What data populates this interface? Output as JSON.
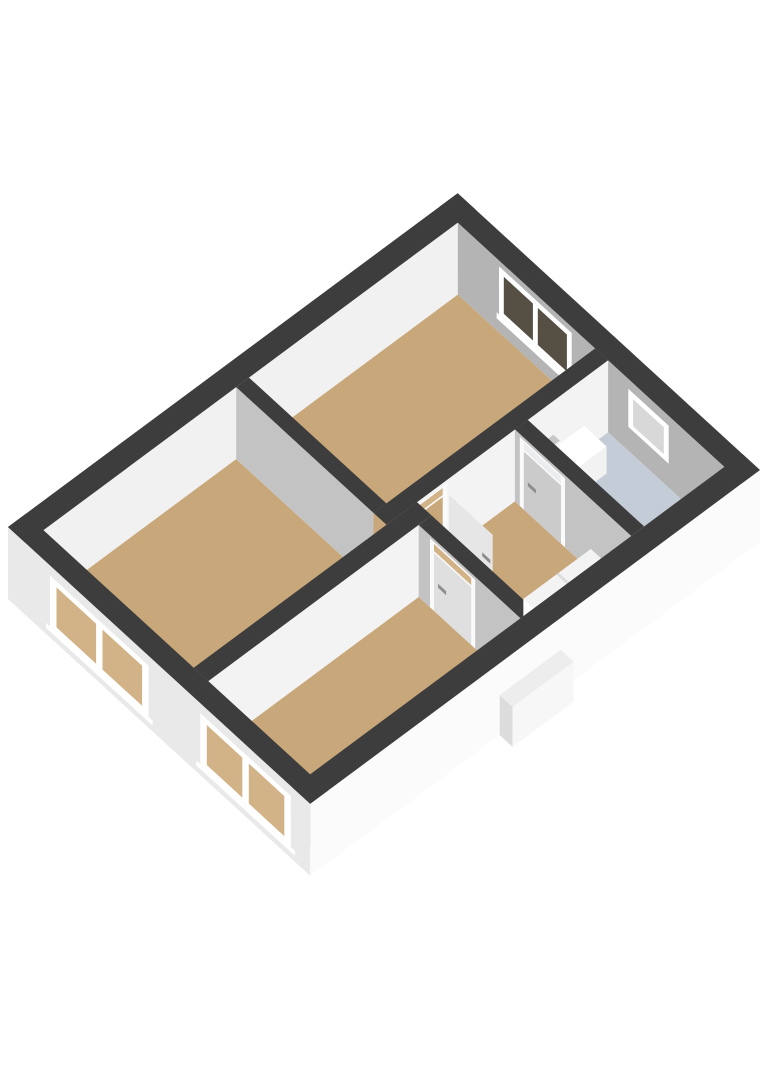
{
  "scene": {
    "width": 768,
    "height": 1086,
    "background": "#ffffff",
    "description-name": "floorplan-3d-view"
  },
  "projection": {
    "origin": [
      8,
      527
    ],
    "u": [
      0.803,
      -0.596
    ],
    "v": [
      0.808,
      0.74
    ],
    "wall_height": 72
  },
  "colors": {
    "cap": "#3d3d3d",
    "floorWood": "#c8a77b",
    "floorBath": "#c3ccd7",
    "innerNW": "#f1f1f1",
    "innerNE": "#b4b4b4",
    "faceBright": "#f3f3f3",
    "facePart": "#c3c3c3",
    "outerSW": "#e9e9e9",
    "outerSE": "#fbfbfb",
    "white": "#ffffff",
    "frame": "#fafafa",
    "glassDark": "#565044",
    "glassLight": "#d8d8d8",
    "glassWood": "#d2b287",
    "doorOpen": "#e6e6e6",
    "doorB": "#cbcbcb",
    "doorC": "#dfdfdf",
    "transomLight": "#e9edf0",
    "handle": "#8d8d8d",
    "stairTop": "#f3f3f3",
    "stairFront": "#fcfcfc",
    "stairSide": "#e8e8e8",
    "stepLine": "#dddddd",
    "sinkFront": "#f2f2f2",
    "sinkSide": "#dadada",
    "faucet": "#9f9f9f",
    "faucetTop": "#c7c7c7",
    "bumpSide": "#dcdcdc",
    "bumpFront": "#f7f7f7",
    "bumpTop": "#ededed"
  },
  "shapes": [
    {
      "name": "nw-wall-inner-face",
      "kind": "wally",
      "at": 22,
      "rect": [
        22,
        0,
        538,
        72
      ],
      "color": "innerNW"
    },
    {
      "name": "ne-wall-inner-face",
      "kind": "wallx",
      "at": 538,
      "rect": [
        22,
        0,
        352,
        72
      ],
      "color": "innerNE"
    },
    {
      "name": "bedroom2-window-sill",
      "kind": "wallx",
      "at": 538,
      "rect": [
        70,
        12,
        166,
        18
      ],
      "color": "white"
    },
    {
      "name": "bedroom2-window-frame",
      "kind": "wallx",
      "at": 538,
      "rect": [
        73,
        18,
        163,
        66
      ],
      "color": "white"
    },
    {
      "name": "bedroom2-window-glass-left",
      "kind": "wallx",
      "at": 538,
      "rect": [
        79,
        23,
        115,
        60
      ],
      "color": "glassDark"
    },
    {
      "name": "bedroom2-window-glass-right",
      "kind": "wallx",
      "at": 538,
      "rect": [
        121,
        23,
        157,
        60
      ],
      "color": "glassDark"
    },
    {
      "name": "bathroom-window-frame",
      "kind": "wallx",
      "at": 538,
      "rect": [
        233,
        24,
        283,
        62
      ],
      "color": "white"
    },
    {
      "name": "bathroom-window-glass",
      "kind": "wallx",
      "at": 538,
      "rect": [
        239,
        29,
        277,
        56
      ],
      "color": "glassLight"
    },
    {
      "name": "bedroom2-floor",
      "kind": "floor",
      "at": 0,
      "rect": [
        278,
        22,
        538,
        192
      ],
      "color": "floorWood"
    },
    {
      "name": "livingroom-floor",
      "kind": "floor",
      "at": 0,
      "rect": [
        22,
        22,
        262,
        208
      ],
      "color": "floorWood"
    },
    {
      "name": "partition-living-bedroom2-face",
      "kind": "wallx",
      "at": 262,
      "rect": [
        22,
        0,
        192,
        72
      ],
      "color": "facePart"
    },
    {
      "name": "partition-living-bedroom2-cap",
      "kind": "floor",
      "at": 72,
      "rect": [
        262,
        22,
        278,
        192
      ],
      "color": "cap"
    },
    {
      "name": "hall-north-wall-face",
      "kind": "wally",
      "at": 208,
      "rect": [
        262,
        0,
        538,
        72
      ],
      "color": "faceBright"
    },
    {
      "name": "bedroom2-doorway-frame",
      "kind": "wally",
      "at": 208,
      "rect": [
        284,
        0,
        338,
        69
      ],
      "color": "frame"
    },
    {
      "name": "bedroom2-doorway-opening",
      "kind": "wally",
      "at": 208,
      "rect": [
        290,
        0,
        332,
        58
      ],
      "color": "floorWood"
    },
    {
      "name": "bedroom2-doorway-transom",
      "kind": "wally",
      "at": 208,
      "rect": [
        290,
        60,
        332,
        67
      ],
      "color": "glassWood"
    },
    {
      "name": "hall-north-wall-cap",
      "kind": "floor",
      "at": 72,
      "rect": [
        262,
        192,
        538,
        208
      ],
      "color": "cap"
    },
    {
      "name": "bathroom-floor",
      "kind": "floor",
      "at": 0,
      "rect": [
        438,
        208,
        538,
        352
      ],
      "color": "floorBath"
    },
    {
      "name": "hall-floor",
      "kind": "floor",
      "at": 0,
      "rect": [
        300,
        208,
        422,
        352
      ],
      "color": "floorWood"
    },
    {
      "name": "bedroom2-door-open-panel",
      "kind": "wallx",
      "at": 338,
      "rect": [
        210,
        0,
        264,
        58
      ],
      "color": "doorOpen"
    },
    {
      "name": "bedroom2-door-handle",
      "kind": "wallx",
      "at": 338,
      "rect": [
        251,
        27,
        261,
        31
      ],
      "color": "handle"
    },
    {
      "name": "sink-side",
      "kind": "wallx",
      "at": 452,
      "rect": [
        210,
        0,
        238,
        27
      ],
      "color": "sinkSide"
    },
    {
      "name": "sink-front",
      "kind": "wally",
      "at": 238,
      "rect": [
        452,
        0,
        506,
        27
      ],
      "color": "sinkFront"
    },
    {
      "name": "sink-top",
      "kind": "floor",
      "at": 27,
      "rect": [
        452,
        210,
        506,
        238
      ],
      "color": "white"
    },
    {
      "name": "sink-faucet-riser",
      "kind": "wally",
      "at": 212,
      "rect": [
        458,
        27,
        463,
        40
      ],
      "color": "faucet"
    },
    {
      "name": "sink-faucet-spout",
      "kind": "floor",
      "at": 38,
      "rect": [
        456,
        208,
        470,
        216
      ],
      "color": "faucetTop"
    },
    {
      "name": "bathroom-door-wall-face",
      "kind": "wallx",
      "at": 422,
      "rect": [
        208,
        0,
        352,
        72
      ],
      "color": "facePart"
    },
    {
      "name": "bathroom-door-frame",
      "kind": "wallx",
      "at": 422,
      "rect": [
        214,
        0,
        270,
        69
      ],
      "color": "frame"
    },
    {
      "name": "bathroom-door-panel",
      "kind": "wallx",
      "at": 422,
      "rect": [
        219,
        0,
        265,
        58
      ],
      "color": "doorB"
    },
    {
      "name": "bathroom-door-transom",
      "kind": "wallx",
      "at": 422,
      "rect": [
        219,
        60,
        265,
        67
      ],
      "color": "transomLight"
    },
    {
      "name": "bathroom-door-handle",
      "kind": "wallx",
      "at": 422,
      "rect": [
        224,
        27,
        234,
        31
      ],
      "color": "handle"
    },
    {
      "name": "bathroom-door-wall-cap",
      "kind": "floor",
      "at": 72,
      "rect": [
        422,
        208,
        438,
        352
      ],
      "color": "cap"
    },
    {
      "name": "partition-living-bedroom3-face",
      "kind": "wally",
      "at": 226,
      "rect": [
        22,
        0,
        300,
        72
      ],
      "color": "faceBright"
    },
    {
      "name": "partition-living-bedroom3-cap",
      "kind": "floor",
      "at": 72,
      "rect": [
        22,
        208,
        300,
        226
      ],
      "color": "cap"
    },
    {
      "name": "bedroom3-door-wall-face",
      "kind": "wallx",
      "at": 284,
      "rect": [
        226,
        0,
        352,
        72
      ],
      "color": "facePart"
    },
    {
      "name": "bedroom3-door-frame",
      "kind": "wallx",
      "at": 284,
      "rect": [
        240,
        0,
        296,
        69
      ],
      "color": "frame"
    },
    {
      "name": "bedroom3-door-panel",
      "kind": "wallx",
      "at": 284,
      "rect": [
        245,
        0,
        291,
        58
      ],
      "color": "doorC"
    },
    {
      "name": "bedroom3-door-transom",
      "kind": "wallx",
      "at": 284,
      "rect": [
        245,
        60,
        291,
        67
      ],
      "color": "glassWood"
    },
    {
      "name": "bedroom3-door-handle",
      "kind": "wallx",
      "at": 284,
      "rect": [
        250,
        27,
        260,
        31
      ],
      "color": "handle"
    },
    {
      "name": "bedroom3-door-wall-cap",
      "kind": "floor",
      "at": 72,
      "rect": [
        284,
        226,
        300,
        352
      ],
      "color": "cap"
    },
    {
      "name": "bedroom3-floor",
      "kind": "floor",
      "at": 0,
      "rect": [
        22,
        226,
        284,
        352
      ],
      "color": "floorWood"
    },
    {
      "name": "stairs-lower-front",
      "kind": "wally",
      "at": 322,
      "rect": [
        306,
        0,
        338,
        10
      ],
      "color": "white"
    },
    {
      "name": "stairs-lower-top",
      "kind": "floor",
      "at": 10,
      "rect": [
        306,
        322,
        338,
        352
      ],
      "color": "stairTop"
    },
    {
      "name": "stairs-side",
      "kind": "wallx",
      "at": 338,
      "rect": [
        302,
        0,
        352,
        22
      ],
      "color": "stairSide"
    },
    {
      "name": "stairs-front",
      "kind": "wally",
      "at": 302,
      "rect": [
        338,
        0,
        422,
        22
      ],
      "color": "stairFront"
    },
    {
      "name": "stairs-top",
      "kind": "floor",
      "at": 22,
      "rect": [
        338,
        302,
        422,
        352
      ],
      "color": "stairTop"
    },
    {
      "name": "stairs-step-edge",
      "kind": "floor",
      "at": 22,
      "rect": [
        379,
        302,
        382,
        352
      ],
      "color": "stepLine"
    },
    {
      "name": "sw-facade",
      "kind": "wallx",
      "at": 0,
      "rect": [
        0,
        0,
        374,
        72
      ],
      "color": "outerSW"
    },
    {
      "name": "window1-sill",
      "kind": "wallx",
      "at": 0,
      "rect": [
        47,
        6,
        179,
        11
      ],
      "color": "white"
    },
    {
      "name": "window1-frame",
      "kind": "wallx",
      "at": 0,
      "rect": [
        52,
        10,
        174,
        62
      ],
      "color": "white"
    },
    {
      "name": "window1-glass-left",
      "kind": "wallx",
      "at": 0,
      "rect": [
        60,
        16,
        109,
        56
      ],
      "color": "glassWood"
    },
    {
      "name": "window1-glass-right",
      "kind": "wallx",
      "at": 0,
      "rect": [
        117,
        16,
        166,
        56
      ],
      "color": "glassWood"
    },
    {
      "name": "window2-sill",
      "kind": "wallx",
      "at": 0,
      "rect": [
        233,
        6,
        355,
        11
      ],
      "color": "white"
    },
    {
      "name": "window2-frame",
      "kind": "wallx",
      "at": 0,
      "rect": [
        238,
        10,
        350,
        62
      ],
      "color": "white"
    },
    {
      "name": "window2-glass-left",
      "kind": "wallx",
      "at": 0,
      "rect": [
        246,
        16,
        290,
        56
      ],
      "color": "glassWood"
    },
    {
      "name": "window2-glass-right",
      "kind": "wallx",
      "at": 0,
      "rect": [
        298,
        16,
        342,
        56
      ],
      "color": "glassWood"
    },
    {
      "name": "se-facade",
      "kind": "wally",
      "at": 374,
      "rect": [
        0,
        0,
        560,
        72
      ],
      "color": "outerSE"
    },
    {
      "name": "stairwell-bump-side",
      "kind": "wallx",
      "at": 236,
      "rect": [
        374,
        0,
        390,
        40
      ],
      "color": "bumpSide"
    },
    {
      "name": "stairwell-bump-front",
      "kind": "wally",
      "at": 390,
      "rect": [
        236,
        0,
        312,
        40
      ],
      "color": "bumpFront"
    },
    {
      "name": "stairwell-bump-top",
      "kind": "floor",
      "at": 40,
      "rect": [
        236,
        374,
        312,
        390
      ],
      "color": "bumpTop"
    },
    {
      "name": "nw-wall-cap",
      "kind": "floor",
      "at": 72,
      "rect": [
        0,
        0,
        560,
        22
      ],
      "color": "cap"
    },
    {
      "name": "ne-wall-cap",
      "kind": "floor",
      "at": 72,
      "rect": [
        538,
        0,
        560,
        374
      ],
      "color": "cap"
    },
    {
      "name": "sw-wall-cap",
      "kind": "floor",
      "at": 72,
      "rect": [
        0,
        0,
        22,
        374
      ],
      "color": "cap"
    },
    {
      "name": "se-wall-cap",
      "kind": "floor",
      "at": 72,
      "rect": [
        0,
        352,
        560,
        374
      ],
      "color": "cap"
    }
  ]
}
